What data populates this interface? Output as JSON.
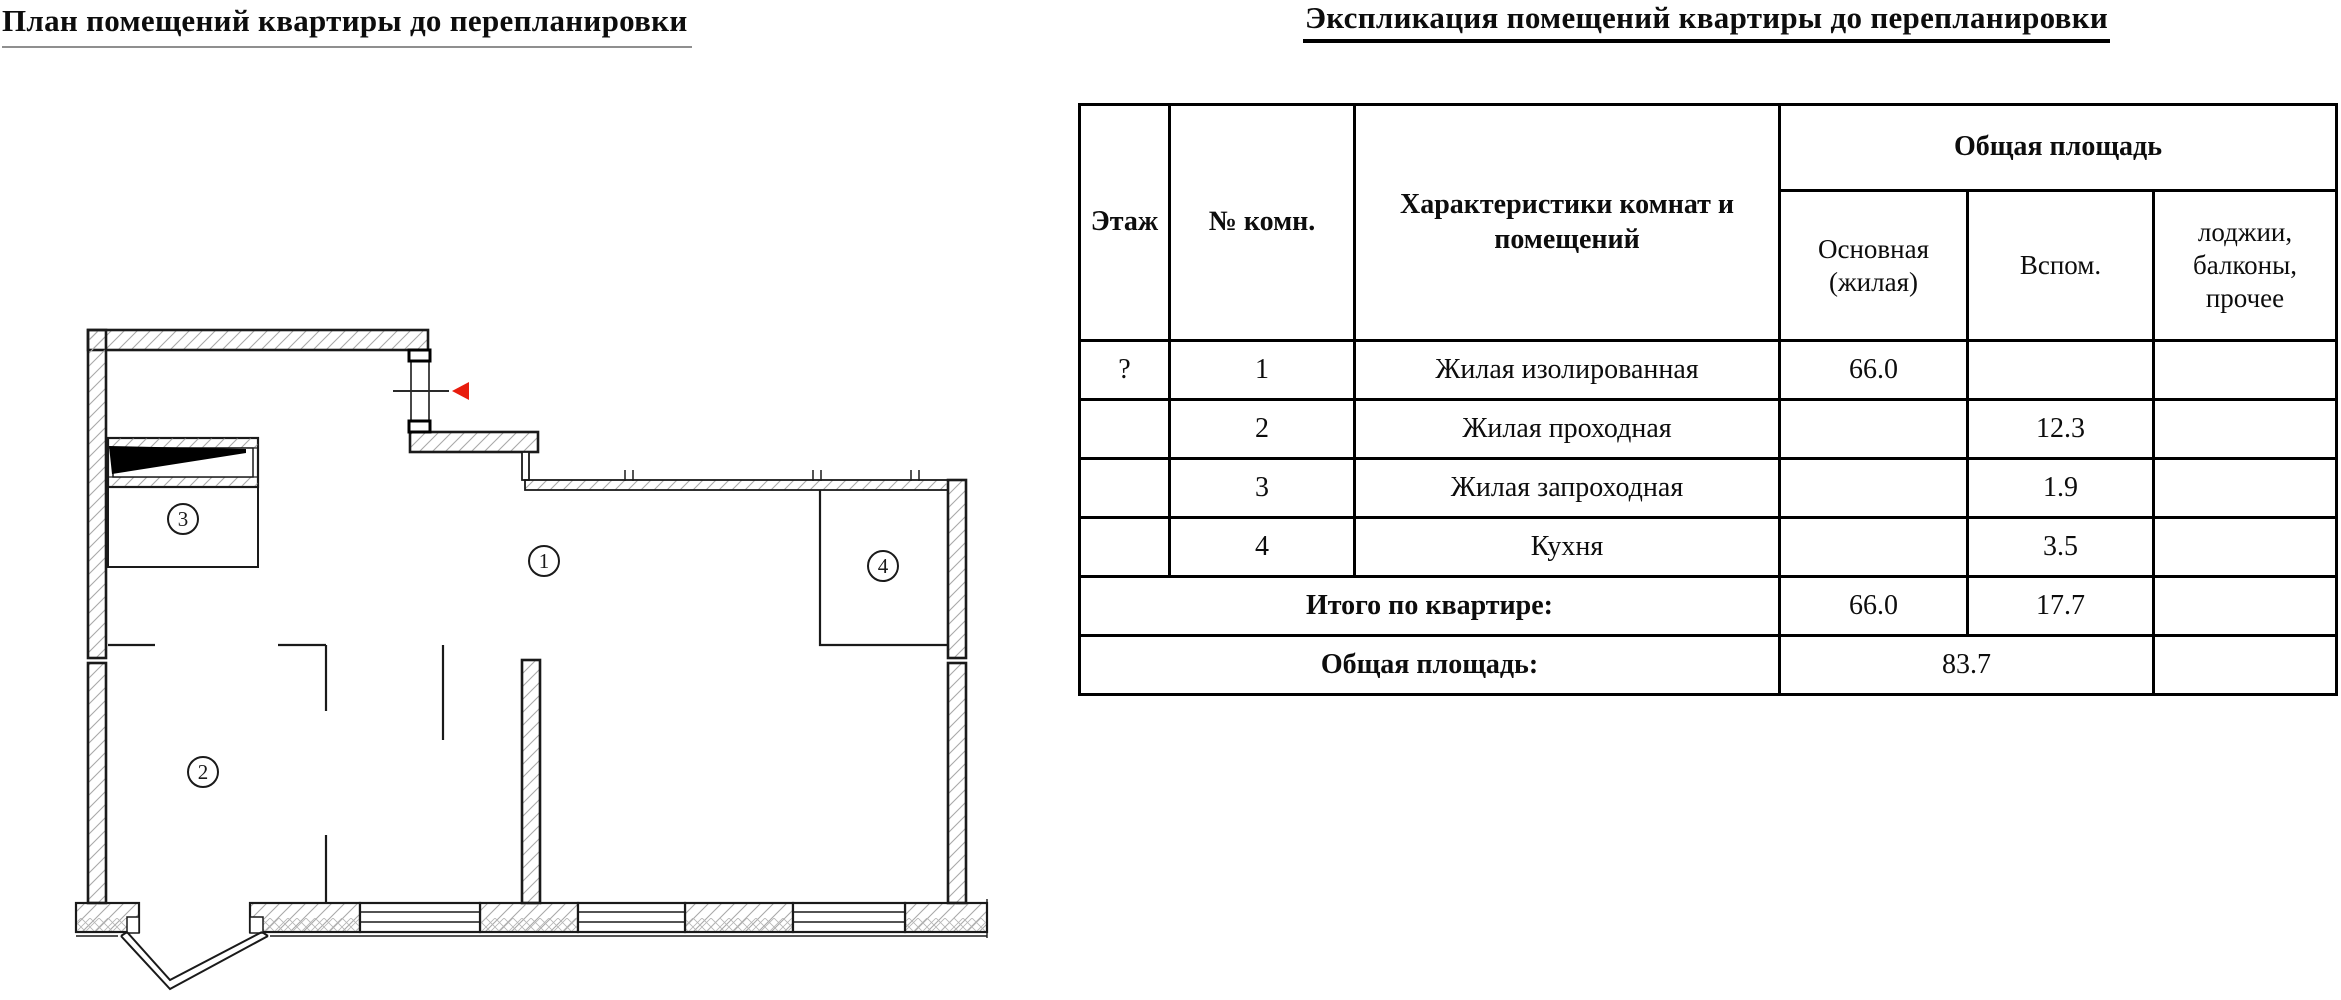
{
  "titles": {
    "plan": "План помещений квартиры до перепланировки",
    "explication": "Экспликация помещений квартиры до перепланировки"
  },
  "table": {
    "headers": {
      "floor": "Этаж",
      "room_no": "№ комн.",
      "characteristics": "Характеристики комнат и помещений",
      "total_area": "Общая площадь",
      "main": "Основная (жилая)",
      "aux": "Вспом.",
      "loggia": "лоджии, балконы, прочее"
    },
    "rows": [
      {
        "floor": "?",
        "num": "1",
        "name": "Жилая изолированная",
        "main": "66.0",
        "aux": "",
        "loggia": ""
      },
      {
        "floor": "",
        "num": "2",
        "name": "Жилая проходная",
        "main": "",
        "aux": "12.3",
        "loggia": ""
      },
      {
        "floor": "",
        "num": "3",
        "name": "Жилая запроходная",
        "main": "",
        "aux": "1.9",
        "loggia": ""
      },
      {
        "floor": "",
        "num": "4",
        "name": "Кухня",
        "main": "",
        "aux": "3.5",
        "loggia": ""
      }
    ],
    "totals": {
      "label": "Итого по квартире:",
      "main": "66.0",
      "aux": "17.7",
      "loggia": ""
    },
    "overall": {
      "label": "Общая площадь:",
      "value": "83.7",
      "loggia": ""
    }
  },
  "plan": {
    "room_labels": [
      "1",
      "2",
      "3",
      "4"
    ],
    "entrance_arrow_color": "#e81c0d",
    "wall_outline_color": "#1a1a1a",
    "hatch_color": "#a9a9a9"
  }
}
